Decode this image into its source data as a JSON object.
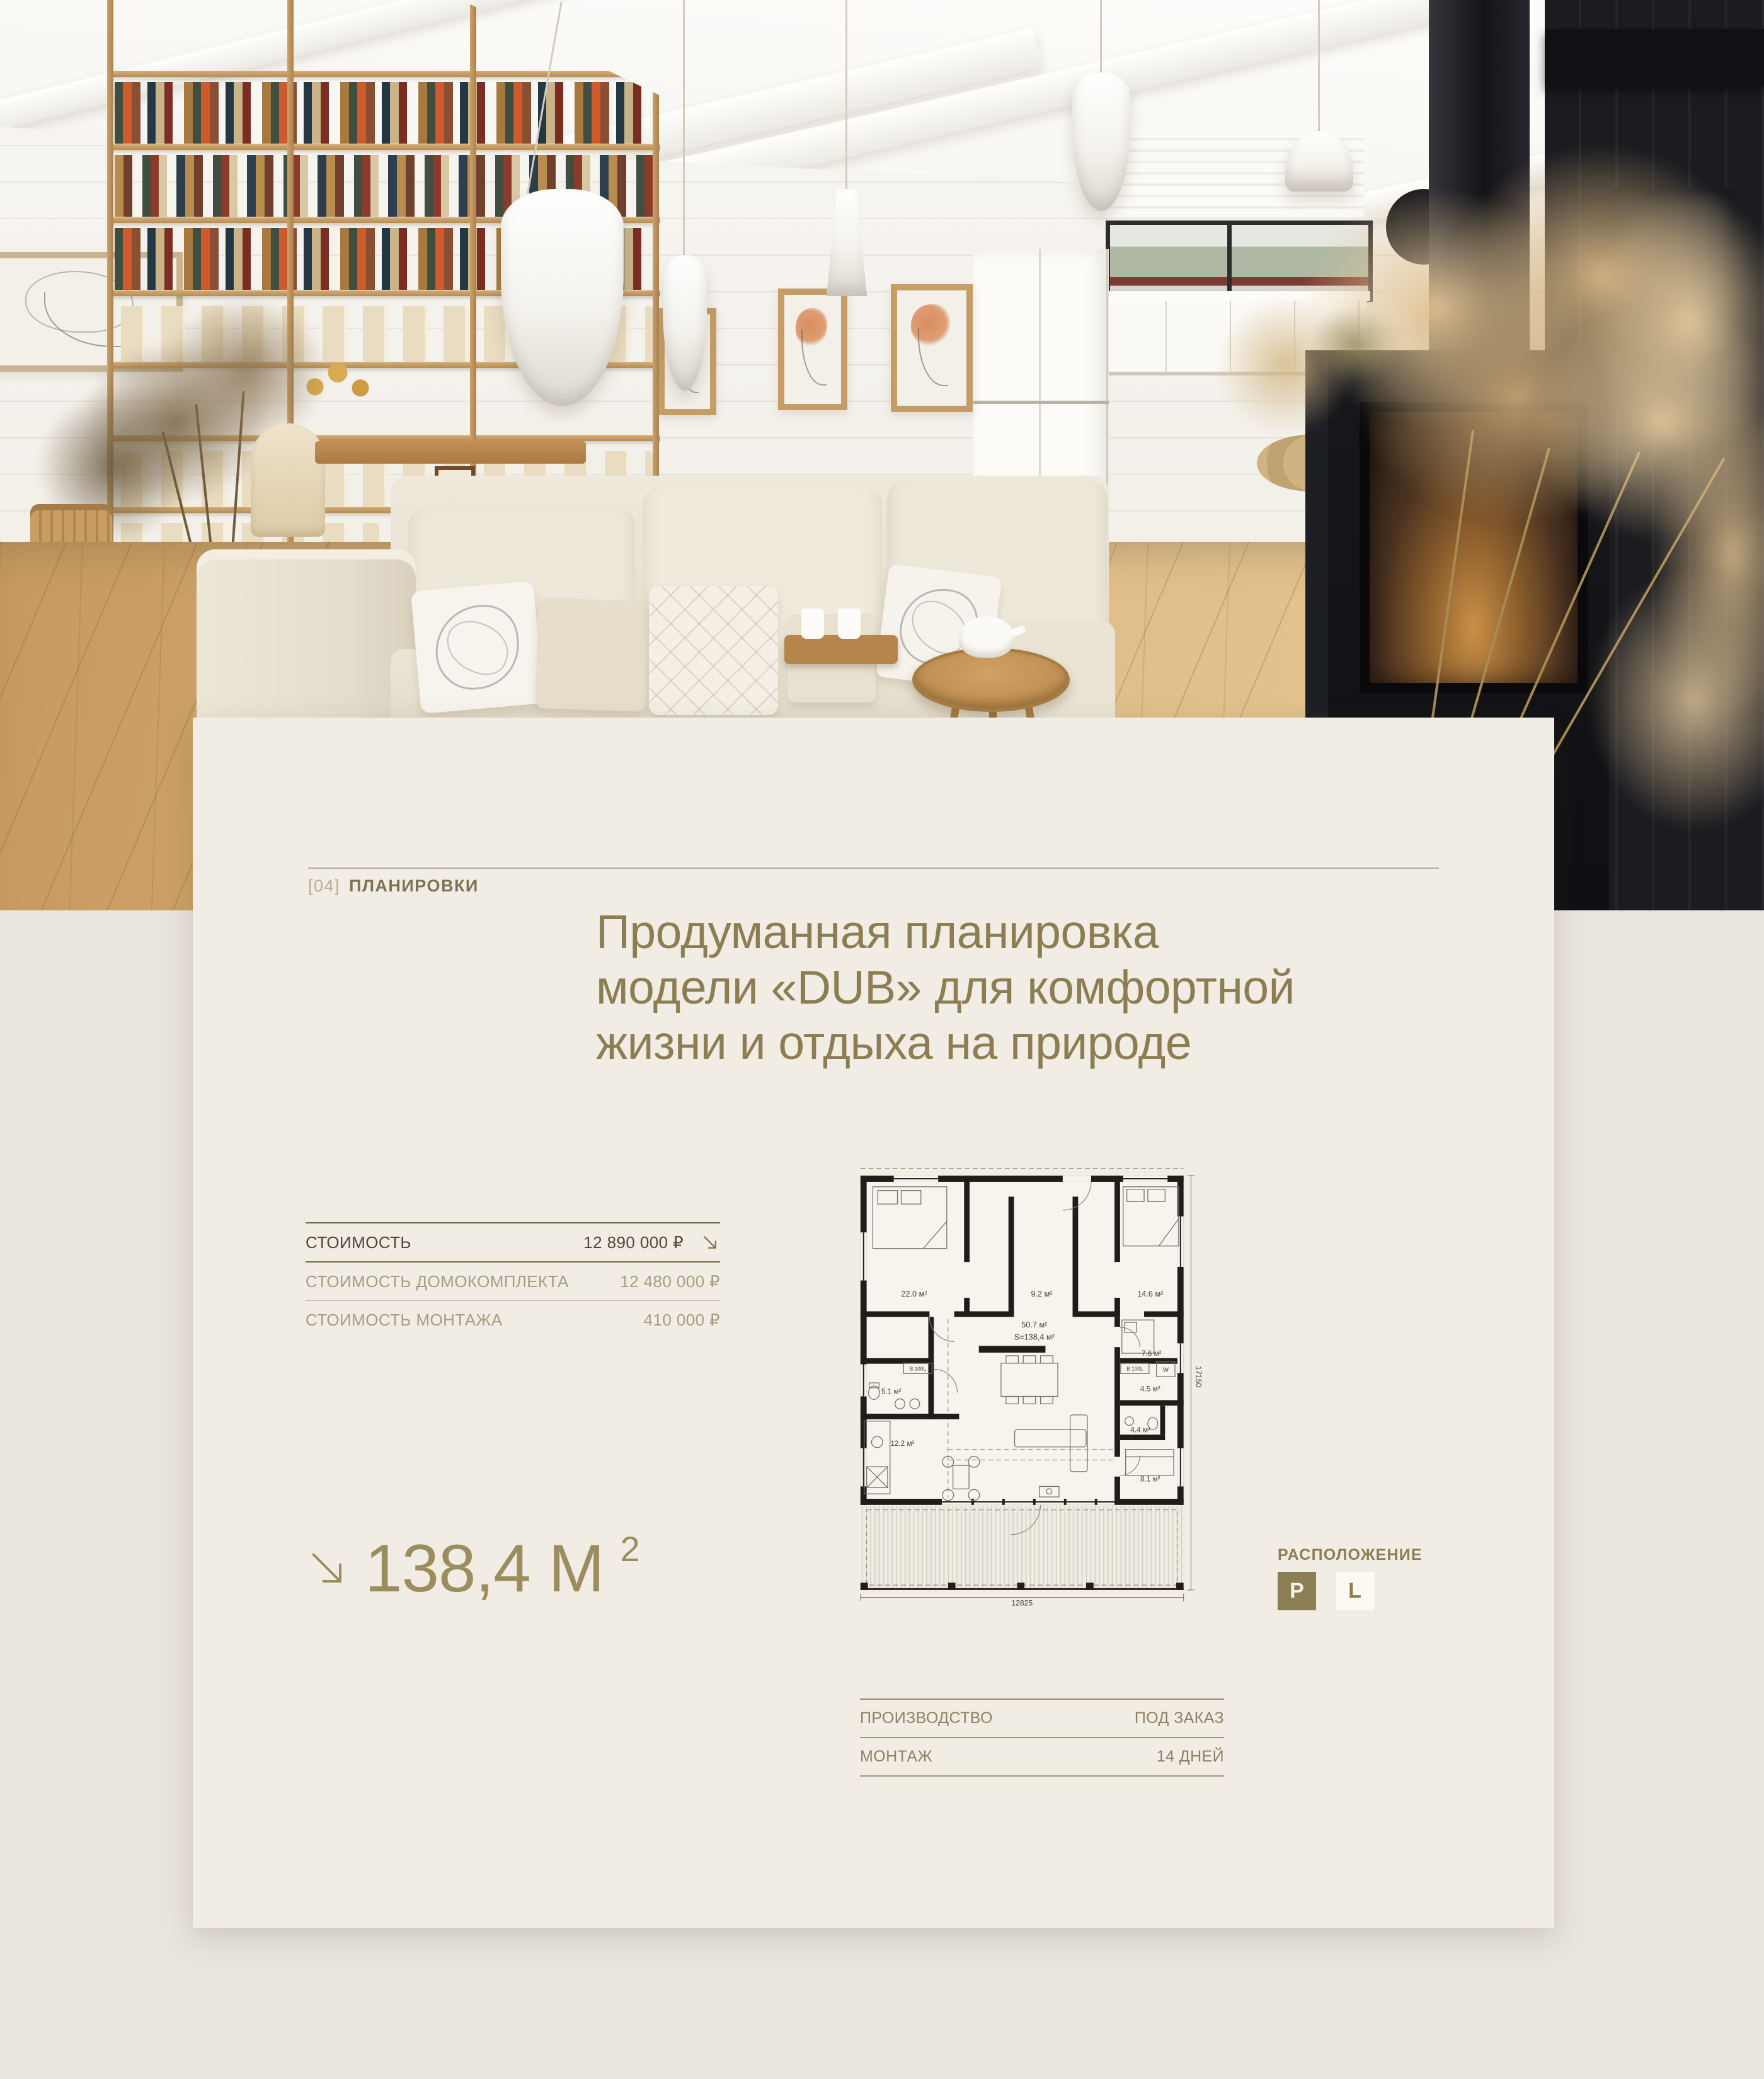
{
  "colors": {
    "page_bg": "#e9e5dd",
    "card_bg": "#f1ede5",
    "accent": "#8c7d52",
    "accent_deep": "#776b4c",
    "text_dark": "#4e4936",
    "text_muted": "#a79d81",
    "plan_wall": "#201d18",
    "location_active_bg": "#8d7f55",
    "location_active_text": "#f7f4ec"
  },
  "icons": {
    "price_arrow": "arrow-down-right-icon",
    "area_arrow": "arrow-down-right-icon"
  },
  "section": {
    "index": "[04]",
    "label": "ПЛАНИРОВКИ"
  },
  "heading": {
    "line1": "Продуманная планировка",
    "line2": "модели «DUB» для комфортной",
    "line3": "жизни и отдыха на природе"
  },
  "pricing": {
    "rows": [
      {
        "label": "СТОИМОСТЬ",
        "value": "12 890 000 ₽"
      },
      {
        "label": "СТОИМОСТЬ ДОМОКОМПЛЕКТА",
        "value": "12 480 000 ₽"
      },
      {
        "label": "СТОИМОСТЬ МОНТАЖА",
        "value": "410 000 ₽"
      }
    ]
  },
  "area": {
    "value": "138,4 М",
    "sup": "2"
  },
  "location": {
    "label": "РАСПОЛОЖЕНИЕ",
    "primary": "P",
    "secondary": "L"
  },
  "production": {
    "rows": [
      {
        "label": "ПРОИЗВОДСТВО",
        "value": "ПОД ЗАКАЗ"
      },
      {
        "label": "МОНТАЖ",
        "value": "14 ДНЕЙ"
      }
    ]
  },
  "plan": {
    "rooms": {
      "bedroom1": "22.0 м²",
      "hall": "9.2 м²",
      "bedroom2": "14.6 м²",
      "living": "50.7 м²",
      "total": "S=138,4 м²",
      "bath": "5.1 м²",
      "dressing": "7.6 м²",
      "laundry": "4.5 м²",
      "wc": "4.4 м²",
      "kitchen": "12.2 м²",
      "cabinet": "8.1 м²"
    },
    "boxes": {
      "boiler_left": "B 100L",
      "boiler_right": "B 100L",
      "washer": "W"
    },
    "dims": {
      "width": "12825",
      "height": "17150"
    }
  }
}
